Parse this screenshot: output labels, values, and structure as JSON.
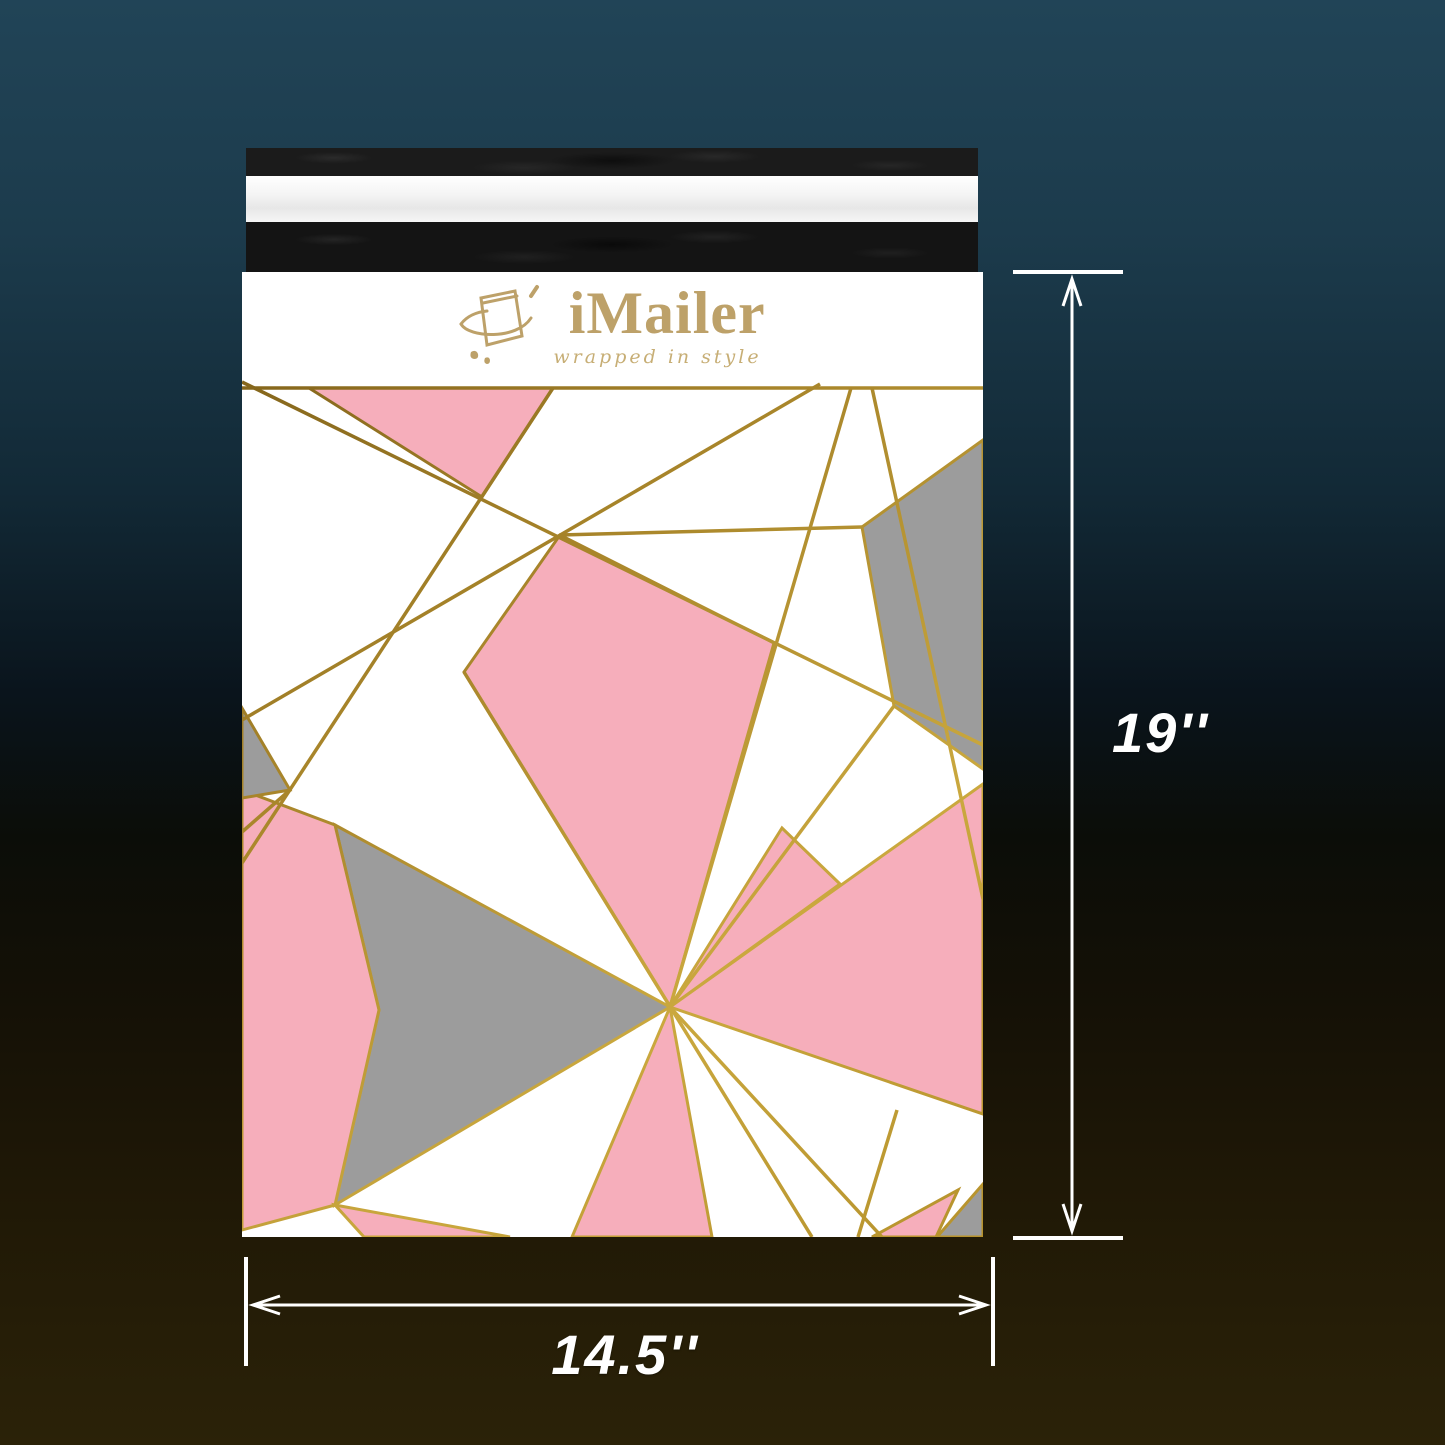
{
  "brand": {
    "name": "iMailer",
    "tagline": "wrapped in style"
  },
  "dimensions": {
    "height": "19''",
    "width": "14.5''"
  },
  "colors": {
    "background_top": "#214457",
    "background_middle": "#0a141c",
    "background_bottom": "#2b2208",
    "mailer_body": "#ffffff",
    "flap_black": "#1b1b1b",
    "flap_liner_white": "#f4f4f4",
    "pattern_pink": "#f6aebb",
    "pattern_gray": "#9c9c9c",
    "pattern_gold": "#b8922d",
    "logo_gold": "#bda169",
    "annotation_white": "#ffffff"
  }
}
